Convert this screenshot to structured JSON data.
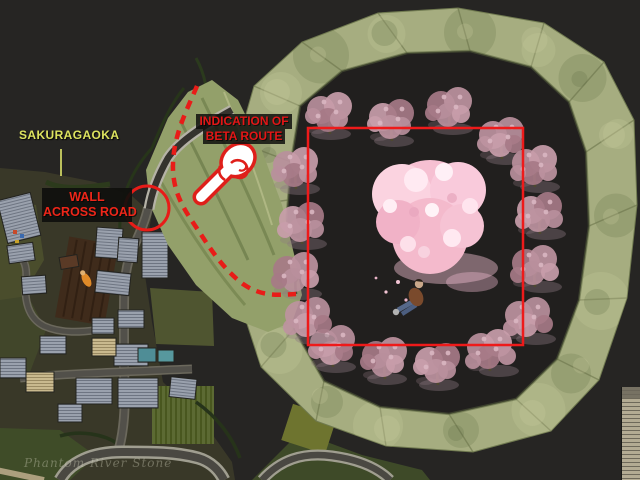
{
  "labels": {
    "region": "SAKURAGAOKA",
    "wall_annotation": {
      "line1": "WALL",
      "line2": "ACROSS ROAD"
    },
    "route_annotation": {
      "line1": "INDICATION OF",
      "line2": "BETA ROUTE"
    }
  },
  "watermark": {
    "text": "Phantom River Stone"
  },
  "icons": {
    "pointing_hand": "pointing-hand-icon",
    "highlight_circle": "circle-highlight-icon",
    "route_dashes": "dashed-route-line",
    "beta_square": "beta-area-outline"
  },
  "colors": {
    "background": "#262523",
    "annotation_red": "#e81c18",
    "label_yellow": "#dde35f",
    "wall_green": "#a6ad80",
    "central_blossom_pink": "#f7c3d4",
    "ring_tree_pink": "#b88f9c",
    "village_road_gray": "#55524a"
  }
}
